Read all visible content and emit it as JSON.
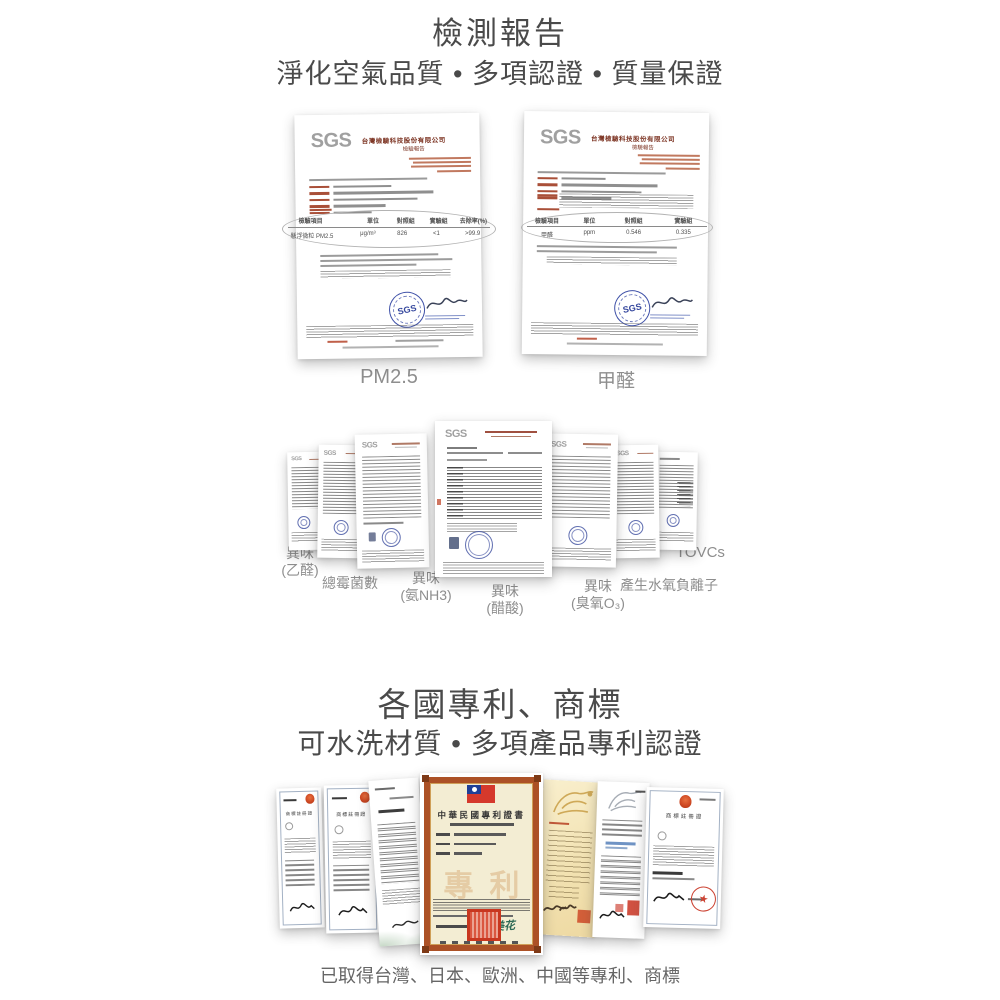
{
  "detection": {
    "title": "檢測報告",
    "subtitle": "淨化空氣品質 • 多項認證 • 質量保證",
    "certs": [
      {
        "brand": "SGS",
        "company": "台灣檢驗科技股份有限公司",
        "report_type": "檢驗報告",
        "label": "PM2.5",
        "stamp_text": "SGS",
        "table": {
          "headers": [
            "檢驗項目",
            "單位",
            "對照組",
            "實驗組",
            "去除率(%)"
          ],
          "row": [
            "懸浮微粒 PM2.5",
            "μg/m³",
            "826",
            "<1",
            ">99.9"
          ]
        }
      },
      {
        "brand": "SGS",
        "company": "台灣檢驗科技股份有限公司",
        "report_type": "檢驗報告",
        "label": "甲醛",
        "stamp_text": "SGS",
        "table": {
          "headers": [
            "檢驗項目",
            "單位",
            "對照組",
            "實驗組"
          ],
          "row": [
            "甲醛",
            "ppm",
            "0.546",
            "0.335"
          ]
        }
      }
    ],
    "fan_reports": [
      {
        "brand": "SGS",
        "label_line1": "異味",
        "label_line2": "(乙醛)"
      },
      {
        "brand": "SGS",
        "label_line1": "總霉菌數",
        "label_line2": ""
      },
      {
        "brand": "SGS",
        "label_line1": "異味",
        "label_line2": "(氨NH3)"
      },
      {
        "brand": "SGS",
        "label_line1": "異味",
        "label_line2": "(醋酸)"
      },
      {
        "brand": "SGS",
        "label_line1": "異味",
        "label_line2": "(臭氧O₃)"
      },
      {
        "brand": "SGS",
        "label_line1": "產生水氧負離子",
        "label_line2": ""
      },
      {
        "brand": "SGS",
        "label_line1": "TOVCs",
        "label_line2": ""
      }
    ]
  },
  "patents": {
    "title": "各國專利、商標",
    "subtitle": "可水洗材質 • 多項產品專利認證",
    "trademark_certificate_title": "商標註冊證",
    "center_certificate": {
      "title": "中華民國專利證書",
      "watermark": "專利",
      "signature": "王美花"
    },
    "caption": "已取得台灣、日本、歐洲、中國等專利、商標"
  }
}
